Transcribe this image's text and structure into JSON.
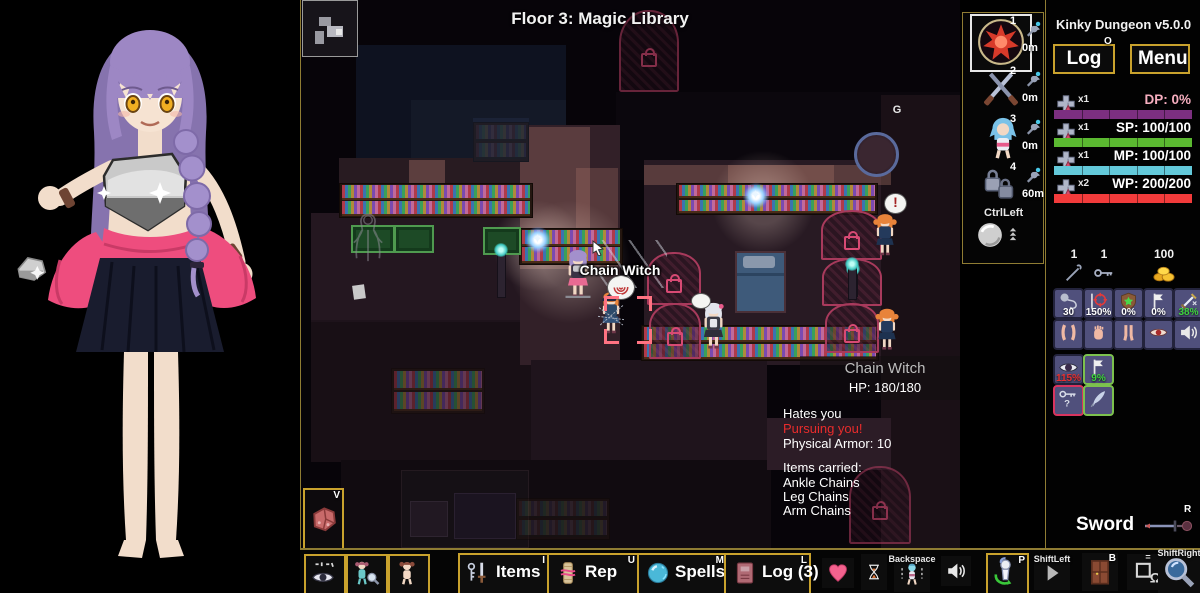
{
  "app": {
    "title": "Kinky Dungeon v5.0.0"
  },
  "map": {
    "floor_title": "Floor 3: Magic Library",
    "target_name_label": "Chain Witch",
    "goal_marker": "G",
    "rects": [
      [
        55,
        45,
        210,
        118,
        "#0e1220",
        0
      ],
      [
        110,
        100,
        155,
        63,
        "#141927",
        0
      ],
      [
        315,
        92,
        345,
        88,
        "#0b070d",
        0
      ],
      [
        38,
        158,
        250,
        112,
        "#281b21",
        1
      ],
      [
        10,
        213,
        278,
        150,
        "#241720",
        1
      ],
      [
        10,
        320,
        278,
        142,
        "#18101576",
        0
      ],
      [
        10,
        322,
        278,
        140,
        "#180f15",
        1
      ],
      [
        219,
        125,
        100,
        240,
        "#322028",
        1
      ],
      [
        343,
        160,
        237,
        205,
        "#281a23",
        1
      ],
      [
        580,
        95,
        80,
        453,
        "#1a1016",
        1
      ],
      [
        230,
        360,
        236,
        110,
        "#1f141c",
        1
      ],
      [
        40,
        460,
        430,
        88,
        "#110b10",
        1
      ],
      [
        466,
        418,
        124,
        52,
        "#2c1c26",
        1
      ],
      [
        108,
        160,
        36,
        58,
        "rgba(178,122,110,0.38)",
        0
      ],
      [
        219,
        127,
        70,
        142,
        "rgba(178,122,110,0.32)",
        0
      ],
      [
        275,
        168,
        42,
        99,
        "rgba(178,122,110,0.28)",
        0
      ],
      [
        343,
        165,
        247,
        20,
        "rgba(178,122,110,0.35)",
        0
      ],
      [
        427,
        165,
        106,
        48,
        "rgba(178,122,110,0.30)",
        0
      ],
      [
        172,
        118,
        56,
        44,
        "#1b2236",
        0
      ]
    ],
    "glows": [
      [
        237,
        246,
        46
      ],
      [
        462,
        202,
        52
      ],
      [
        268,
        262,
        62
      ]
    ],
    "shelves": [
      {
        "r": [
          38,
          183,
          192,
          33
        ],
        "dim": false,
        "navy": false
      },
      {
        "r": [
          218,
          228,
          102,
          35
        ],
        "dim": false,
        "navy": false
      },
      {
        "r": [
          375,
          183,
          200,
          30
        ],
        "dim": false,
        "navy": false
      },
      {
        "r": [
          340,
          325,
          236,
          34
        ],
        "dim": false,
        "navy": false
      },
      {
        "r": [
          90,
          368,
          92,
          44
        ],
        "dim": true,
        "navy": false
      },
      {
        "r": [
          172,
          122,
          54,
          38
        ],
        "dim": true,
        "navy": true
      },
      {
        "r": [
          215,
          498,
          92,
          40
        ],
        "dim": true,
        "navy": true
      }
    ],
    "tables": [
      [
        50,
        225,
        40,
        24
      ],
      [
        93,
        225,
        36,
        24
      ],
      [
        182,
        227,
        34,
        24
      ]
    ],
    "doors": [
      [
        318,
        10,
        56,
        78,
        1,
        0,
        1
      ],
      [
        346,
        252,
        50,
        49,
        1,
        0,
        0
      ],
      [
        348,
        303,
        48,
        52,
        1,
        0,
        0
      ],
      [
        520,
        210,
        57,
        46,
        1,
        0,
        0
      ],
      [
        521,
        258,
        56,
        44,
        0,
        1,
        0
      ],
      [
        524,
        303,
        50,
        46,
        1,
        0,
        0
      ],
      [
        548,
        466,
        58,
        74,
        1,
        0,
        1
      ]
    ],
    "orbs": [
      [
        237,
        240
      ],
      [
        455,
        196
      ]
    ],
    "torches": [
      [
        196,
        250,
        46
      ],
      [
        547,
        264,
        34
      ]
    ],
    "sprites": [
      {
        "name": "player-sprite",
        "x": 262,
        "y": 248,
        "h": 50,
        "hair": "#a390cc",
        "dress": "#3a3344",
        "skirt": "#e86a92",
        "skin": "#f2d8c4",
        "pedestal": true,
        "chest": "#c8c8cc"
      },
      {
        "name": "enemy-chain-witch-sprite",
        "x": 297,
        "y": 290,
        "h": 44,
        "hair": "#e8833a",
        "dress": "#2e4a6a",
        "skirt": "#32527a",
        "skin": "#f2d8c4",
        "hat": true,
        "chains": true
      },
      {
        "name": "npc-maid-sprite",
        "x": 398,
        "y": 301,
        "h": 48,
        "hair": "#e2e4ec",
        "dress": "#3a3a46",
        "skirt": "#2e2e3a",
        "skin": "#f2d8c4",
        "bow": "#e85a8a",
        "apron": true
      },
      {
        "name": "enemy-sprite",
        "x": 571,
        "y": 212,
        "h": 44,
        "hair": "#e8833a",
        "dress": "#243a5c",
        "skirt": "#1e3250",
        "skin": "#f2d8c4",
        "pigtails": true
      },
      {
        "name": "enemy-sprite",
        "x": 573,
        "y": 307,
        "h": 43,
        "hair": "#e8833a",
        "dress": "#243a5c",
        "skirt": "#1e3250",
        "skin": "#f2d8c4",
        "pigtails": true
      }
    ],
    "bubbles": [
      {
        "x": 306,
        "y": 275,
        "w": 26,
        "h": 23,
        "kind": "spiral"
      },
      {
        "x": 390,
        "y": 293,
        "w": 18,
        "h": 14,
        "kind": "blank"
      },
      {
        "x": 583,
        "y": 193,
        "w": 21,
        "h": 19,
        "kind": "excl",
        "glyph": "!"
      }
    ],
    "reticle": [
      303,
      296,
      48,
      48
    ],
    "bed": [
      434,
      251,
      47,
      58
    ],
    "portal": [
      553,
      132,
      39,
      39
    ],
    "ghost": [
      50,
      211,
      34,
      52
    ],
    "furniture": [
      [
        100,
        470,
        126,
        76
      ]
    ],
    "paper": [
      52,
      285
    ],
    "cursor": [
      291,
      240
    ],
    "meat_button": {
      "hotkey": "V"
    }
  },
  "tooltip": {
    "name": "Chain Witch",
    "hp": "HP: 180/180",
    "lines": [
      {
        "text": "Hates you",
        "color": "#ffffff",
        "y": 50
      },
      {
        "text": "Pursuing you!",
        "color": "#e82c2c",
        "y": 65
      },
      {
        "text": "Physical Armor: 10",
        "color": "#ffffff",
        "y": 80
      },
      {
        "text": "Items carried:",
        "color": "#ffffff",
        "y": 104
      },
      {
        "text": "Ankle Chains",
        "color": "#ffffff",
        "y": 119
      },
      {
        "text": "Leg Chains",
        "color": "#ffffff",
        "y": 133
      },
      {
        "text": "Arm Chains",
        "color": "#ffffff",
        "y": 147
      }
    ]
  },
  "weapon_slots": {
    "slots": [
      {
        "num": "1",
        "icon": "spell-orb",
        "range": "0m",
        "selected": true,
        "y": 14,
        "ih": 50
      },
      {
        "num": "2",
        "icon": "crossed-swords",
        "range": "0m",
        "selected": false,
        "y": 64,
        "ih": 42
      },
      {
        "num": "3",
        "icon": "doll-blue",
        "range": "0m",
        "selected": false,
        "y": 112,
        "ih": 46
      },
      {
        "num": "4",
        "icon": "locks",
        "range": "60m",
        "selected": false,
        "y": 160,
        "ih": 38
      }
    ],
    "push": {
      "hotkey": "CtrlLeft"
    }
  },
  "right_panel": {
    "title": "Kinky Dungeon v5.0.0",
    "log_button": {
      "label": "Log",
      "hotkey": "O"
    },
    "menu_button": {
      "label": "Menu"
    },
    "stats": [
      {
        "id": "dp",
        "count": "x1",
        "label": "DP: 0%",
        "label_color": "#f6aebf",
        "bar_color": "#7c2f80",
        "fill": 1
      },
      {
        "id": "sp",
        "count": "x1",
        "label": "SP: 100/100",
        "label_color": "#ffffff",
        "bar_color": "#5bb931",
        "fill": 1
      },
      {
        "id": "mp",
        "count": "x1",
        "label": "MP: 100/100",
        "label_color": "#ffffff",
        "bar_color": "#63c9da",
        "fill": 1
      },
      {
        "id": "wp",
        "count": "x2",
        "label": "WP: 200/200",
        "label_color": "#ffffff",
        "bar_color": "#f23b3b",
        "fill": 1
      }
    ],
    "resources": [
      {
        "icon": "lockpick",
        "count": "1",
        "x": 1056
      },
      {
        "icon": "key",
        "count": "1",
        "x": 1086
      },
      {
        "icon": "gold",
        "count": "100",
        "x": 1146
      }
    ],
    "status_grid": [
      {
        "row": 0,
        "col": 0,
        "icon": "rope-orb",
        "value": "30",
        "value_color": "#ffffff"
      },
      {
        "row": 0,
        "col": 1,
        "icon": "crosshair",
        "value": "150%",
        "value_color": "#ffffff"
      },
      {
        "row": 0,
        "col": 2,
        "icon": "shield-target",
        "value": "0%",
        "value_color": "#ffffff"
      },
      {
        "row": 0,
        "col": 3,
        "icon": "flag",
        "value": "0%",
        "value_color": "#ffffff"
      },
      {
        "row": 0,
        "col": 4,
        "icon": "dagger",
        "value": "38%",
        "value_color": "#3ed43e"
      },
      {
        "row": 1,
        "col": 0,
        "icon": "arms",
        "value": "",
        "value_color": "#ffffff"
      },
      {
        "row": 1,
        "col": 1,
        "icon": "hand",
        "value": "",
        "value_color": "#ffffff"
      },
      {
        "row": 1,
        "col": 2,
        "icon": "legs",
        "value": "",
        "value_color": "#ffffff"
      },
      {
        "row": 1,
        "col": 3,
        "icon": "eye",
        "value": "",
        "value_color": "#ffffff"
      },
      {
        "row": 1,
        "col": 4,
        "icon": "speaker",
        "value": "",
        "value_color": "#ffffff"
      },
      {
        "row": 2,
        "col": 0,
        "icon": "big-eye",
        "value": "115%",
        "value_color": "#e83030"
      },
      {
        "row": 2,
        "col": 1,
        "icon": "flag",
        "value": "9%",
        "value_color": "#3ed43e",
        "border": "#7cc14e"
      },
      {
        "row": 3,
        "col": 0,
        "icon": "key-question",
        "value": "",
        "value_color": "#ffffff",
        "border": "#d8345f"
      },
      {
        "row": 3,
        "col": 1,
        "icon": "quill",
        "value": "",
        "value_color": "#ffffff",
        "border": "#7cc14e"
      }
    ],
    "equipped_weapon": {
      "label": "Sword",
      "hotkey": "R"
    }
  },
  "bottom_bar": {
    "buttons": [
      {
        "x": 4,
        "y": 4,
        "w": 38,
        "h": 38,
        "icon": "eye-config",
        "border": true,
        "name": "vision-toggle-button"
      },
      {
        "x": 46,
        "y": 4,
        "w": 38,
        "h": 38,
        "icon": "doll-inspect",
        "border": true,
        "name": "inspect-doll-button"
      },
      {
        "x": 88,
        "y": 4,
        "w": 38,
        "h": 38,
        "icon": "doll",
        "border": true,
        "name": "doll-button"
      },
      {
        "x": 158,
        "y": 3,
        "w": 87,
        "h": 39,
        "icon": "key-sword",
        "label": "Items",
        "hotkey": "I",
        "border": true,
        "name": "items-button"
      },
      {
        "x": 247,
        "y": 3,
        "w": 88,
        "h": 39,
        "icon": "scroll",
        "label": "Rep",
        "hotkey": "U",
        "border": true,
        "name": "reputation-button"
      },
      {
        "x": 337,
        "y": 3,
        "w": 87,
        "h": 39,
        "icon": "orb",
        "label": "Spells",
        "hotkey": "M",
        "border": true,
        "name": "spells-button"
      },
      {
        "x": 424,
        "y": 3,
        "w": 83,
        "h": 39,
        "icon": "book",
        "label": "Log (3)",
        "hotkey": "L",
        "border": true,
        "name": "log-button"
      },
      {
        "x": 522,
        "y": 8,
        "w": 32,
        "h": 30,
        "icon": "heart",
        "border": false,
        "name": "heart-icon-button"
      },
      {
        "x": 561,
        "y": 4,
        "w": 26,
        "h": 36,
        "icon": "hourglass",
        "border": false,
        "name": "wait-button"
      },
      {
        "x": 594,
        "y": 6,
        "w": 36,
        "h": 36,
        "icon": "struggle-doll",
        "border": false,
        "label2": "Backspace",
        "name": "struggle-button"
      },
      {
        "x": 641,
        "y": 6,
        "w": 30,
        "h": 30,
        "icon": "speaker",
        "border": false,
        "name": "sound-button"
      },
      {
        "x": 686,
        "y": 3,
        "w": 39,
        "h": 39,
        "icon": "doll-arrow",
        "hotkey": "P",
        "border": true,
        "name": "pose-button"
      },
      {
        "x": 734,
        "y": 6,
        "w": 36,
        "h": 34,
        "icon": "play",
        "border": false,
        "label2": "ShiftLeft",
        "name": "fast-forward-button"
      },
      {
        "x": 782,
        "y": 3,
        "w": 36,
        "h": 38,
        "icon": "door",
        "hotkey": "B",
        "border": false,
        "name": "door-button"
      },
      {
        "x": 827,
        "y": 4,
        "w": 42,
        "h": 36,
        "icon": "omega-square",
        "border": false,
        "label2": "=",
        "name": "resolution-button"
      },
      {
        "x": 858,
        "y": 0,
        "w": 42,
        "h": 44,
        "icon": "magnifier",
        "border": false,
        "label2": "ShiftRight",
        "name": "zoom-button"
      }
    ]
  }
}
